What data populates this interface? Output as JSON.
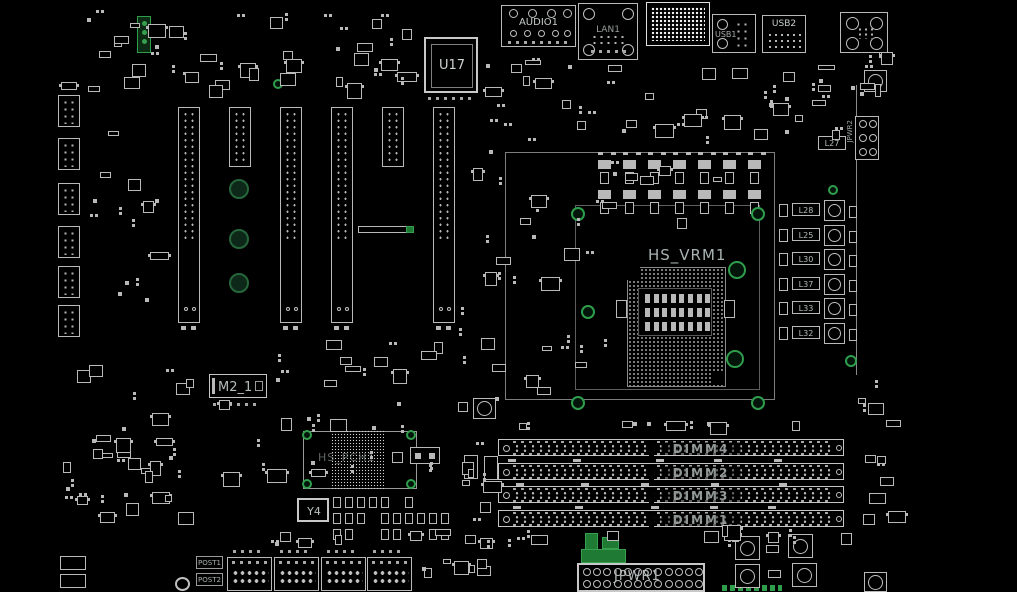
{
  "view": {
    "type": "pcb-boardview",
    "background": "#000000"
  },
  "colors": {
    "board_bg": "#000000",
    "silkscreen": "#bfbfbf",
    "label_text": "#b9c0c0",
    "hole_green": "#2f9e4c",
    "connector_green": "#1f7a33"
  },
  "labels": {
    "u17": "U17",
    "hs_vrm1": "HS_VRM1",
    "hs_pch1": "HS_PCH1",
    "m2_1": "M2_1",
    "y4": "Y4",
    "jpwr1": "JPWR1",
    "jpwr2": "JPWR2",
    "audio1": "AUDIO1",
    "lan1": "LAN1",
    "usb1": "USB1",
    "usb2": "USB2",
    "post1": "POST1",
    "post2": "POST2",
    "l27": "L27"
  },
  "dimm_slots": [
    {
      "label": "DIMM4"
    },
    {
      "label": "DIMM2"
    },
    {
      "label": "DIMM3"
    },
    {
      "label": "DIMM1"
    }
  ],
  "vrm_inductors": [
    {
      "label": "L28"
    },
    {
      "label": "L25"
    },
    {
      "label": "L30"
    },
    {
      "label": "L37"
    },
    {
      "label": "L33"
    },
    {
      "label": "L32"
    }
  ]
}
